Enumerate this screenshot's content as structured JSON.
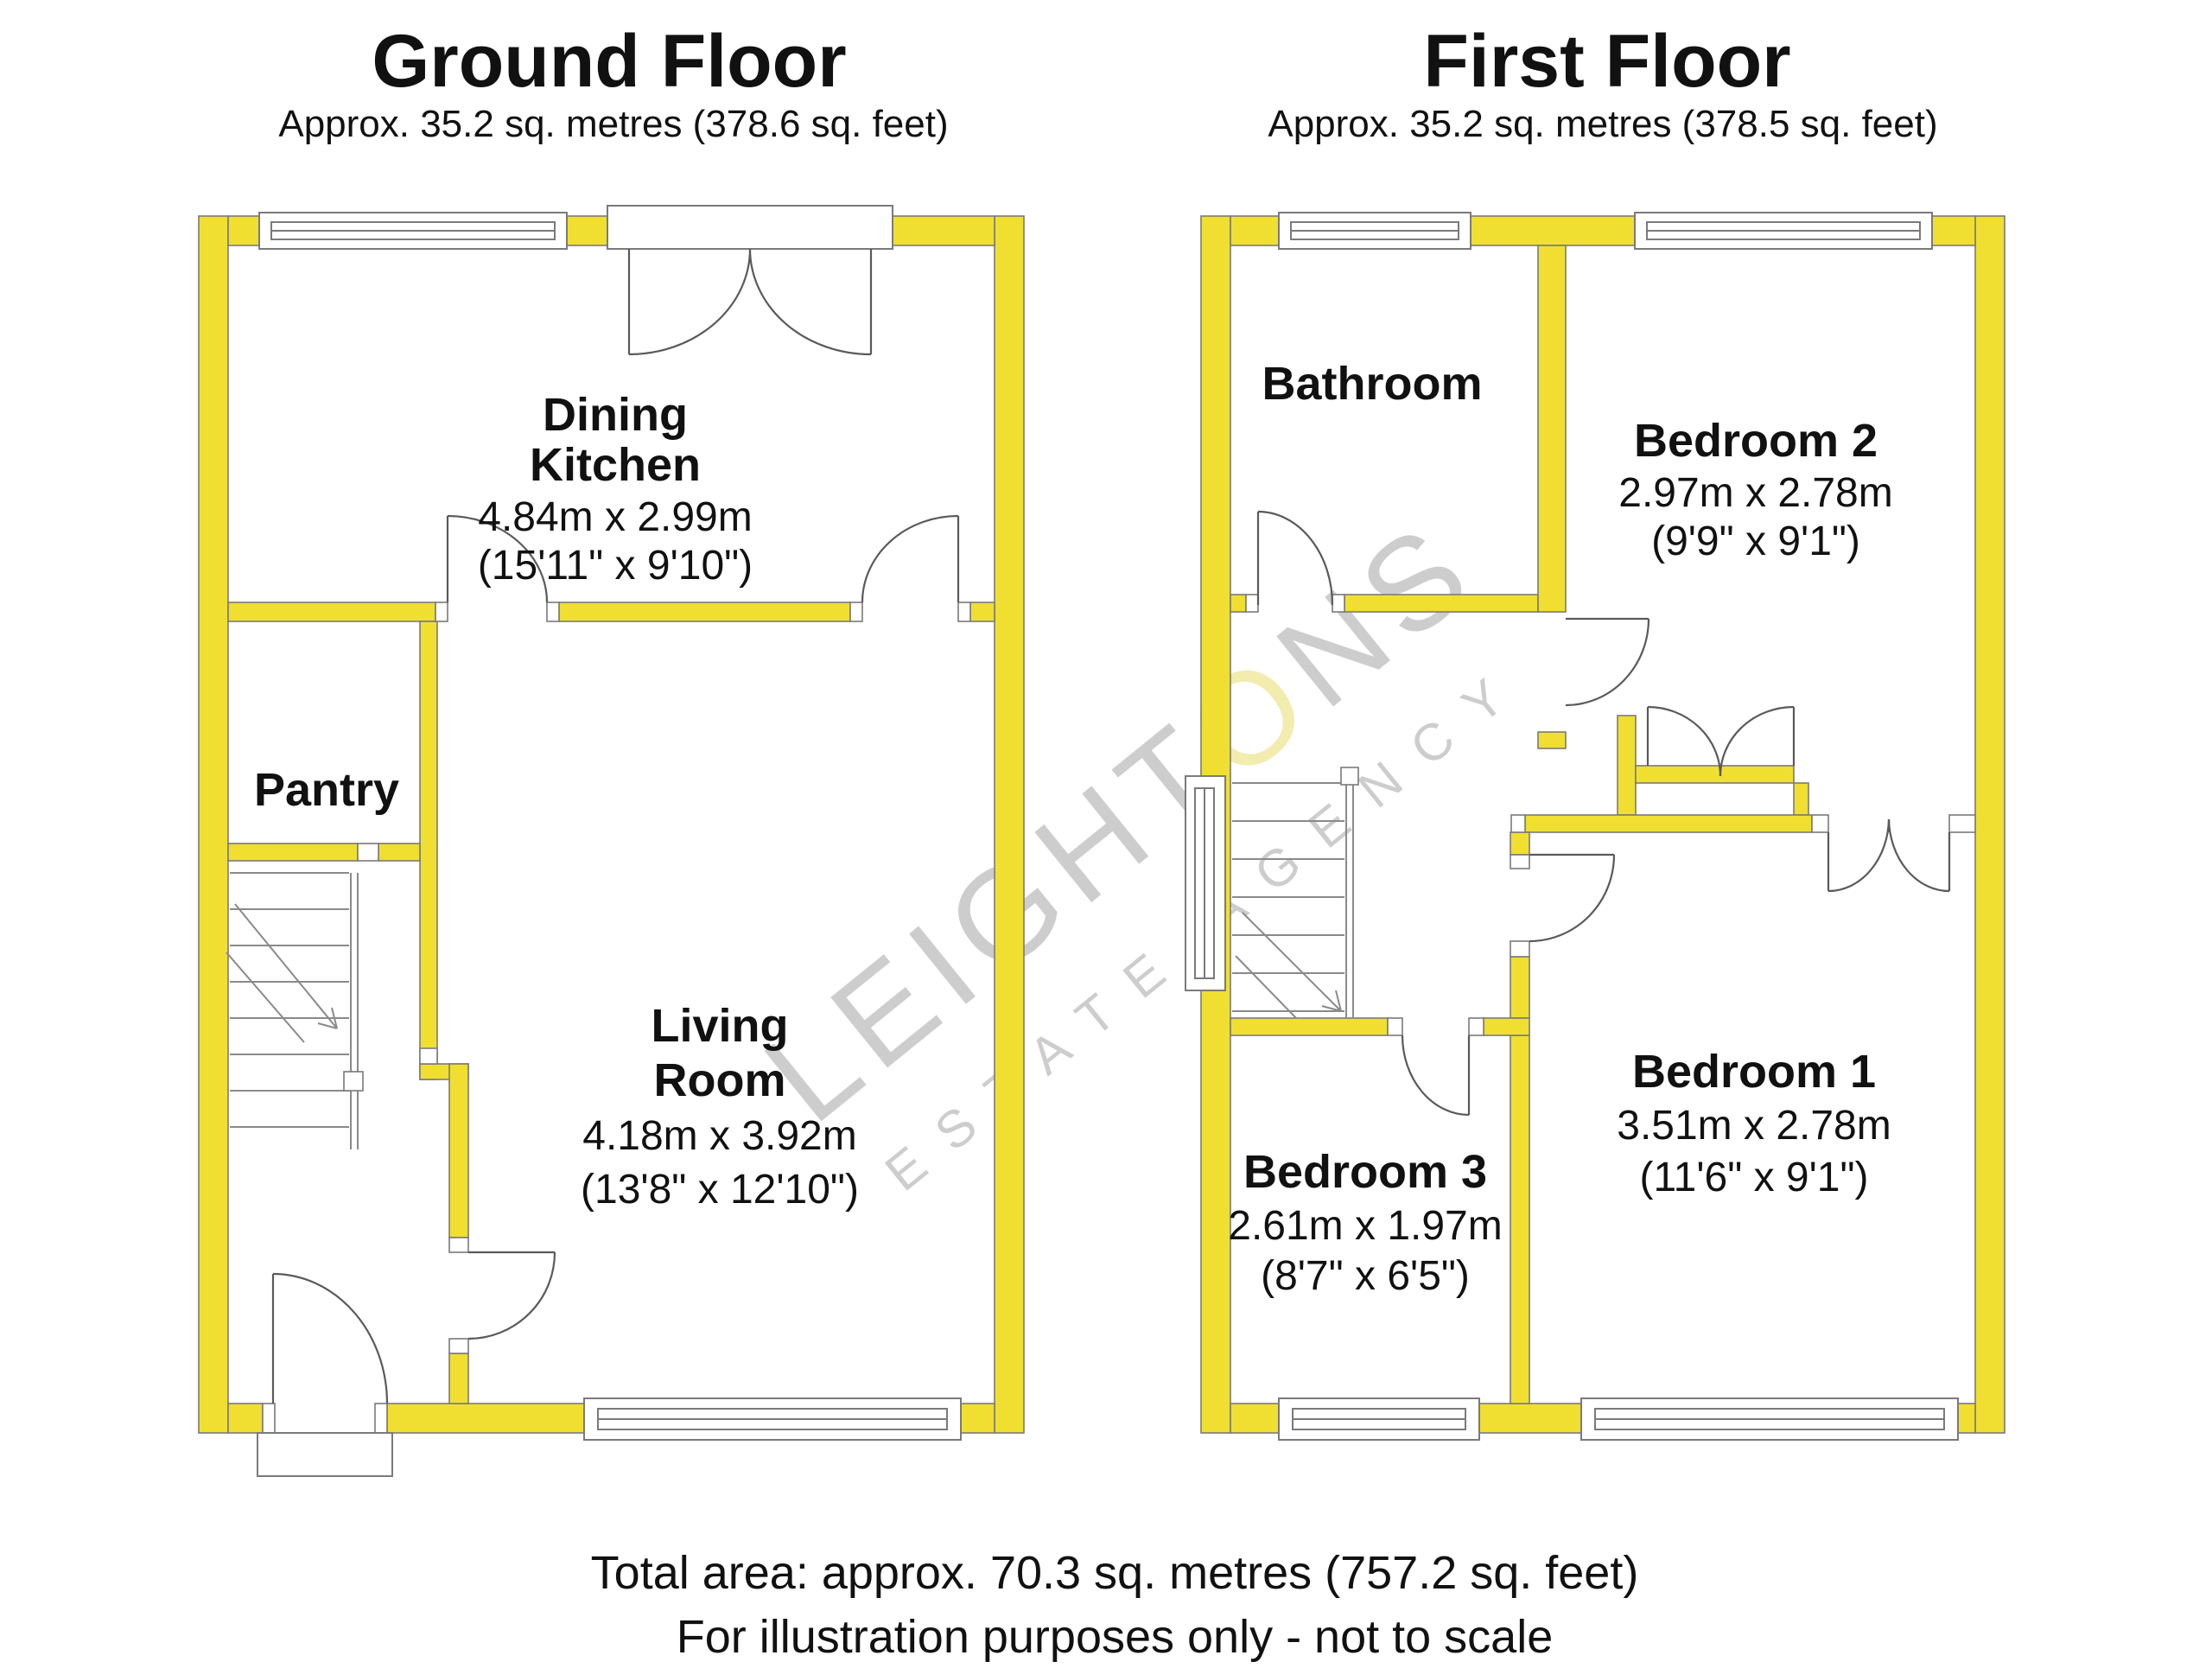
{
  "colors": {
    "wall_fill": "#F0DF31",
    "wall_outline": "#7a7a7a",
    "door_line": "#5a5a5a",
    "text": "#111111",
    "watermark": "#cdcdcd",
    "watermark_accent": "#f2ecae"
  },
  "watermark": {
    "brand_prefix": "LEIGHT",
    "brand_accent": "O",
    "brand_suffix": "NS",
    "tagline": "ESTATE AGENCY"
  },
  "ground_floor": {
    "title": "Ground Floor",
    "subtitle": "Approx. 35.2 sq. metres (378.6 sq. feet)",
    "rooms": {
      "dining_kitchen": {
        "line1": "Dining",
        "line2": "Kitchen",
        "metric": "4.84m x 2.99m",
        "imperial": "(15'11\" x 9'10\")"
      },
      "pantry": {
        "name": "Pantry"
      },
      "living_room": {
        "line1": "Living",
        "line2": "Room",
        "metric": "4.18m x 3.92m",
        "imperial": "(13'8\" x 12'10\")"
      }
    }
  },
  "first_floor": {
    "title": "First Floor",
    "subtitle": "Approx. 35.2 sq. metres (378.5 sq. feet)",
    "rooms": {
      "bathroom": {
        "name": "Bathroom"
      },
      "bedroom_2": {
        "name": "Bedroom 2",
        "metric": "2.97m x 2.78m",
        "imperial": "(9'9\" x 9'1\")"
      },
      "bedroom_1": {
        "name": "Bedroom 1",
        "metric": "3.51m x 2.78m",
        "imperial": "(11'6\" x 9'1\")"
      },
      "bedroom_3": {
        "name": "Bedroom 3",
        "metric": "2.61m x 1.97m",
        "imperial": "(8'7\" x 6'5\")"
      }
    }
  },
  "footer": {
    "line1": "Total area: approx. 70.3 sq. metres (757.2 sq. feet)",
    "line2": "For illustration purposes only - not to scale"
  }
}
